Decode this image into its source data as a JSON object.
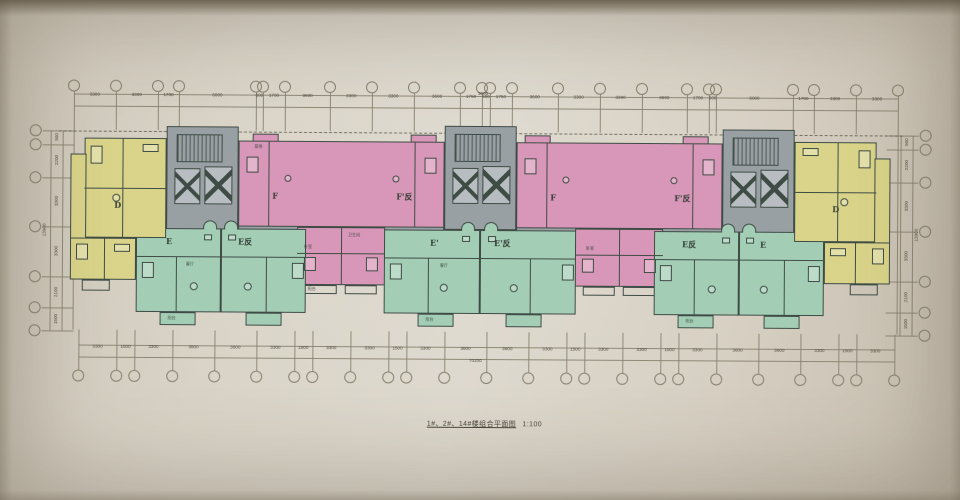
{
  "caption": {
    "title": "1#、2#、14#楼组合平面图",
    "scale": "1:100"
  },
  "dimensions": {
    "top": {
      "values": [
        "3300",
        "3300",
        "1700",
        "6000",
        "600",
        "1700",
        "3600",
        "3300",
        "3300",
        "3600",
        "1750",
        "600",
        "1750",
        "3600",
        "3300",
        "3300",
        "3600",
        "1700",
        "600",
        "6000",
        "1700",
        "3300",
        "3300"
      ]
    },
    "top_center_extra": "3000",
    "bottom": {
      "values": [
        "3300",
        "1500",
        "3300",
        "3600",
        "3600",
        "3300",
        "1500",
        "3300",
        "3300",
        "1500",
        "3300",
        "3600",
        "3600",
        "3300",
        "1500",
        "3300",
        "3300",
        "1500",
        "3300",
        "3600",
        "3600",
        "3300",
        "1500",
        "3300"
      ],
      "total": "70200"
    },
    "left": {
      "values": [
        "900",
        "2200",
        "3300",
        "3300",
        "2100",
        "1500"
      ],
      "total": "13900"
    },
    "right": {
      "values": [
        "900",
        "2200",
        "3300",
        "3300",
        "2100",
        "1500"
      ],
      "total": "13900"
    }
  },
  "unit_labels": {
    "d": "D",
    "e": "E",
    "e_mirror": "E反",
    "e_prime": "E'",
    "e_prime_mirror": "E'反",
    "f": "F",
    "f_prime_mirror": "F'反"
  },
  "room_labels": {
    "bedroom": "卧室",
    "living": "客厅",
    "balcony": "阳台",
    "kitchen": "厨房",
    "bath": "卫生间"
  },
  "colors": {
    "paper": "#d8d2c6",
    "unit_d_yellow": "#d9d489",
    "unit_e_green": "#a3ceb5",
    "unit_f_pink": "#d897b8",
    "core_gray": "#98a0a4",
    "lift": "#b7bdc0",
    "wall": "#3f4b45",
    "grid_line": "#87816f",
    "dim_text": "#4f4a3f"
  }
}
